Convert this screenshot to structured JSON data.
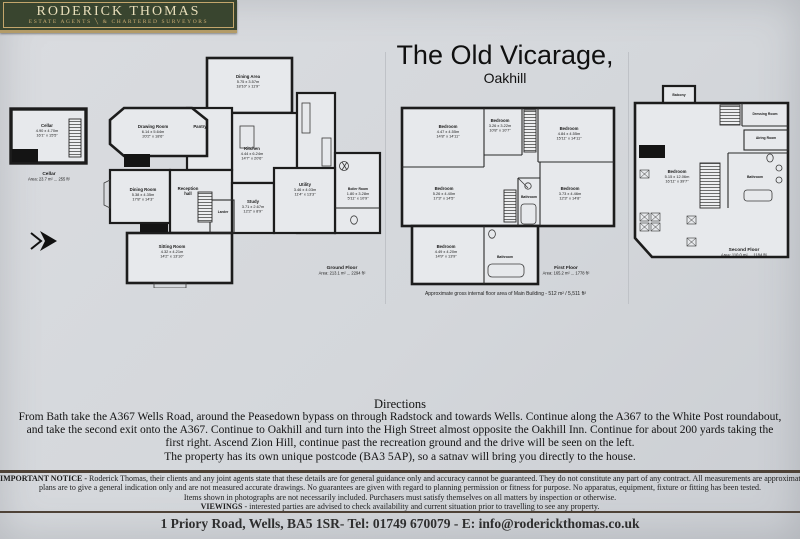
{
  "logo": {
    "title": "RODERICK THOMAS",
    "subtitle": "ESTATE AGENTS  ╲  & CHARTERED SURVEYORS"
  },
  "header": {
    "title": "The Old Vicarage,",
    "subtitle": "Oakhill"
  },
  "plans": {
    "cellar": {
      "room": {
        "name": "Cellar",
        "metric": "4.90 x 4.70m",
        "imperial": "16'1\" x 15'5\""
      },
      "caption_title": "Cellar",
      "caption_area": "Area: 23.7 m² ... 255 ft²"
    },
    "ground": {
      "rooms": {
        "dining_area": {
          "name": "Dining Area",
          "metric": "5.75 x 3.57m",
          "imperial": "18'10\" x 11'9\""
        },
        "drawing_room": {
          "name": "Drawing Room",
          "metric": "6.14 x 5.64m",
          "imperial": "20'2\" x 18'6\""
        },
        "pantry": {
          "name": "Pantry"
        },
        "kitchen": {
          "name": "Kitchen",
          "metric": "4.44 x 6.24m",
          "imperial": "14'7\" x 20'6\""
        },
        "dining_room": {
          "name": "Dining Room",
          "metric": "5.38 x 4.35m",
          "imperial": "17'8\" x 14'3\""
        },
        "reception_hall": {
          "name": "Reception",
          "name2": "hall"
        },
        "larder": {
          "name": "Larder"
        },
        "sitting_room": {
          "name": "Sitting Room",
          "metric": "4.32 x 4.21m",
          "imperial": "14'2\" x 13'10\""
        },
        "study": {
          "name": "Study",
          "metric": "3.71 x 2.67m",
          "imperial": "12'2\" x 8'9\""
        },
        "utility": {
          "name": "Utility",
          "metric": "3.46 x 4.03m",
          "imperial": "11'4\" x 13'3\""
        },
        "boiler_room": {
          "name": "Boiler Room",
          "metric": "1.80 x 3.28m",
          "imperial": "5'11\" x 10'9\""
        }
      },
      "caption_title": "Ground Floor",
      "caption_area": "Area: 213.1 m² ... 2294 ft²"
    },
    "first": {
      "rooms": {
        "bedroom_tl": {
          "name": "Bedroom",
          "metric": "4.47 x 4.55m",
          "imperial": "14'8\" x 14'11\""
        },
        "bedroom_tm": {
          "name": "Bedroom",
          "metric": "3.26 x 3.22m",
          "imperial": "10'8\" x 10'7\""
        },
        "bedroom_tr": {
          "name": "Bedroom",
          "metric": "4.84 x 4.55m",
          "imperial": "15'11\" x 14'11\""
        },
        "bedroom_bl": {
          "name": "Bedroom",
          "metric": "5.26 x 4.40m",
          "imperial": "17'3\" x 14'5\""
        },
        "bathroom_mid": {
          "name": "Bathroom"
        },
        "bedroom_br": {
          "name": "Bedroom",
          "metric": "3.73 x 4.46m",
          "imperial": "12'3\" x 14'8\""
        },
        "bedroom_lower": {
          "name": "Bedroom",
          "metric": "4.49 x 4.20m",
          "imperial": "14'9\" x 13'9\""
        },
        "bathroom_lower": {
          "name": "Bathroom"
        }
      },
      "caption_title": "First Floor",
      "caption_area": "Area: 165.2 m² ... 1778 ft²",
      "note": "Approximate gross internal floor area of Main Building  -  512 m² / 5,511 ft²"
    },
    "second": {
      "rooms": {
        "balcony": {
          "name": "Balcony"
        },
        "dressing_room": {
          "name": "Dressing Room"
        },
        "airing_room": {
          "name": "Airing Room"
        },
        "bedroom": {
          "name": "Bedroom",
          "metric": "5.15 x 12.06m",
          "imperial": "16'11\" x 39'7\""
        },
        "bathroom": {
          "name": "Bathroom"
        }
      },
      "caption_title": "Second Floor",
      "caption_area": "Area: 110.0 m² ... 1184 ft²"
    }
  },
  "directions": {
    "heading": "Directions",
    "line1": "From Bath take the A367 Wells Road, around the Peasedown bypass on through Radstock and towards Wells. Continue along the A367 to the White Post roundabout,",
    "line2": "and take the second exit onto the A367. Continue to Oakhill and turn into the High Street almost opposite the Oakhill Inn. Continue for about 200 yards taking the",
    "line3": "first right. Ascend Zion Hill, continue past the recreation ground and the drive will be seen on the left.",
    "line4": "The property has its own unique postcode (BA3 5AP), so a satnav will bring you directly to the house."
  },
  "notice": {
    "label": "IMPORTANT NOTICE - ",
    "line1_rest": "Roderick Thomas, their clients and any joint agents state that these details are for general guidance only and accuracy cannot be guaranteed. They do not constitute any part of any contract. All measurements are approximate and floor",
    "line2": "plans are to give a general indication only and are not measured accurate drawings.  No guarantees are given with regard to planning permission or fitness for purpose.  No apparatus, equipment, fixture or fitting has been tested.",
    "line3": "Items shown in photographs are not necessarily included.  Purchasers must satisfy themselves on all matters by inspection or otherwise.",
    "viewings_label": "VIEWINGS",
    "line4_rest": " - interested parties are advised to check availability and current situation prior to travelling to see any property."
  },
  "footer": "1 Priory Road, Wells, BA5 1SR- Tel: 01749 670079 - E: info@roderickthomas.co.uk"
}
